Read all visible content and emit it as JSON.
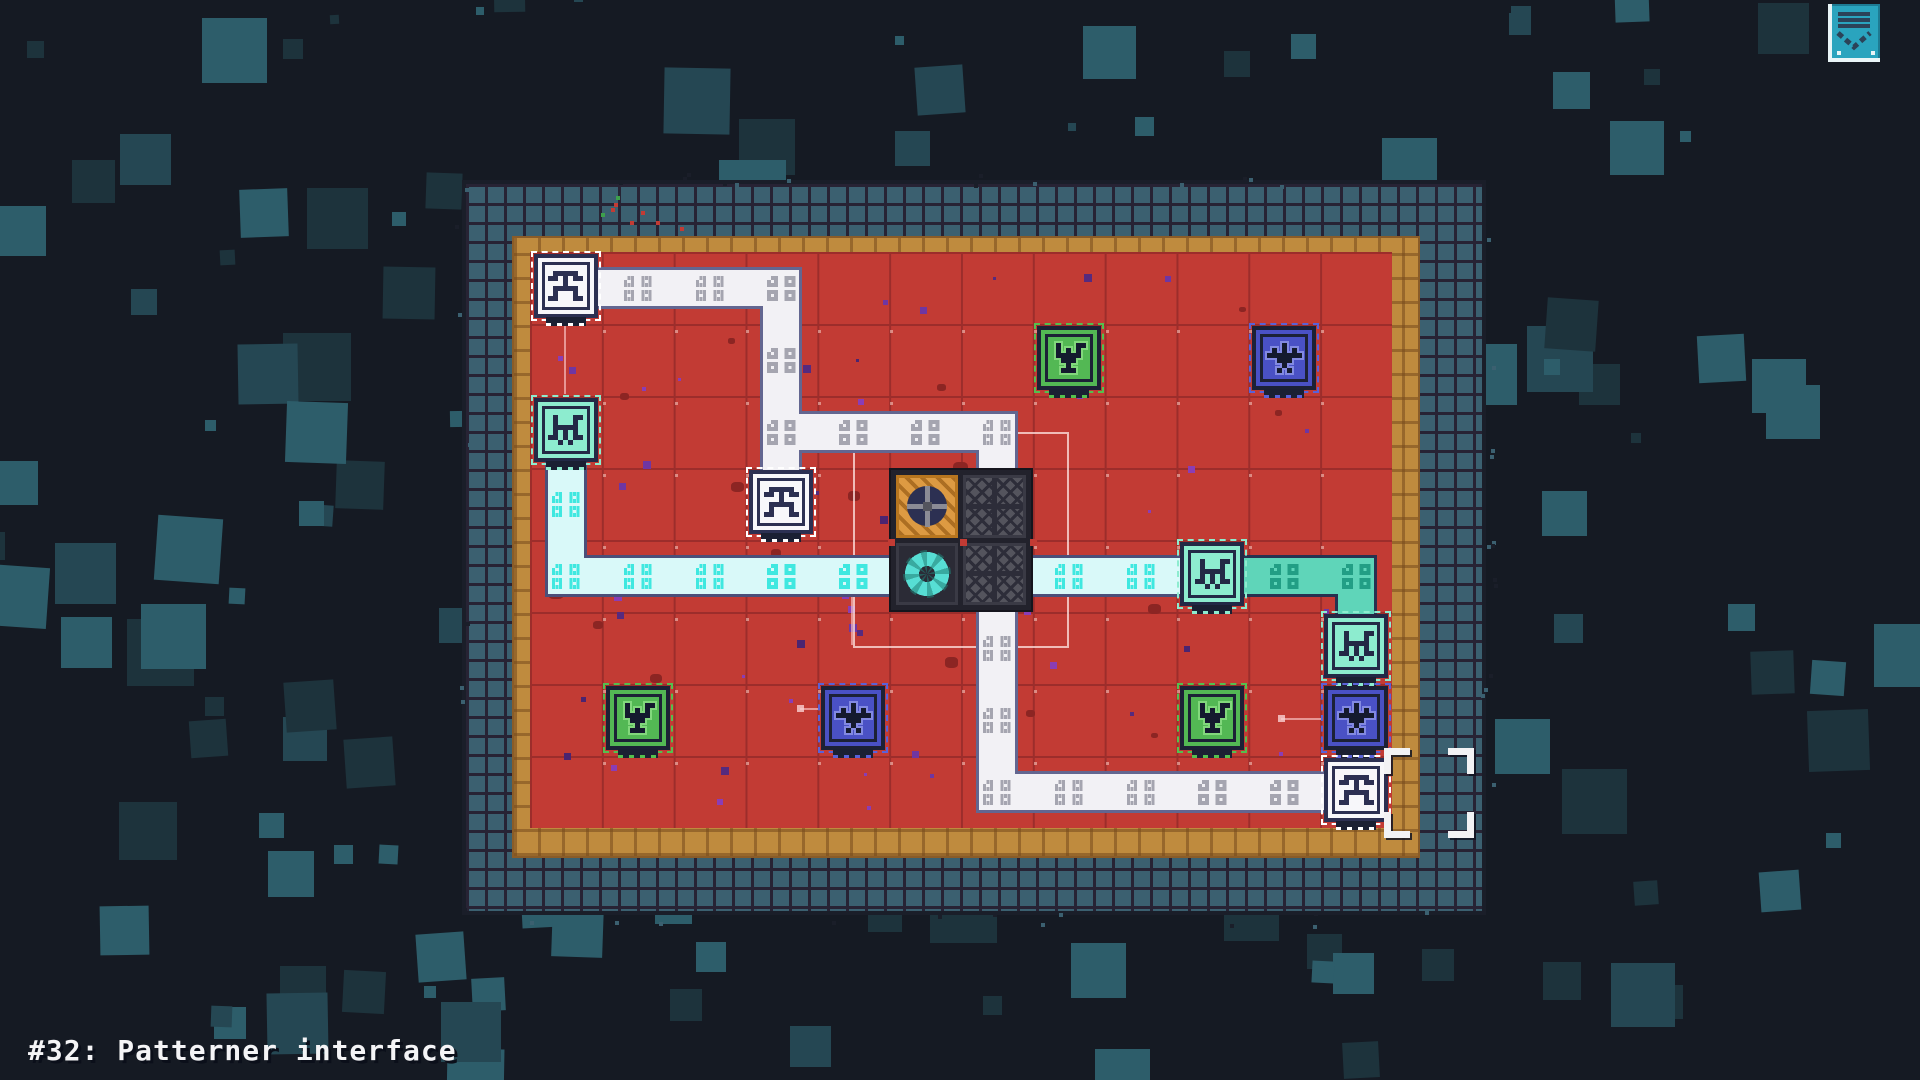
{
  "hud": {
    "level_label": "#32: Patterner interface",
    "menu_button": {
      "icon": "tray-list-icon"
    }
  },
  "palette": {
    "background": "#151a23",
    "background_square_dim": "#1d333c",
    "background_square_mid": "#254753",
    "background_square_bright": "#2d5d6a",
    "frame_fill": "#3b6070",
    "frame_line": "#272334",
    "gold_border": "#bf8b3e",
    "field_red": "#c23b34",
    "field_grid_line": "#9c2d2b",
    "path_white": "#f2f1f5",
    "path_white_ornament": "#a5a5b0",
    "path_cyan": "#d9f9f9",
    "path_cyan_ornament": "#3fe8e0",
    "path_mint": "#5fd5b9",
    "path_mint_ornament": "#229e85",
    "tile_navy": "#2c3052",
    "tile_white_face": "#f7f7fa",
    "tile_mint_face": "#8deccf",
    "tile_green_face": "#53b854",
    "tile_blue_face": "#4a51c5",
    "machine_orange": "#dd9a42",
    "machine_gray": "#54545d",
    "machine_ring_cyan": "#57ded4",
    "selection_white": "#f2f2f4",
    "button_teal": "#2aa4be"
  },
  "board": {
    "cols": 12,
    "rows": 8,
    "geometry": {
      "field_x": 530,
      "field_y": 252,
      "cell_w": 71.833,
      "cell_h": 72,
      "frame": [
        462,
        180,
        1024,
        735
      ],
      "gold": [
        512,
        236,
        908,
        622
      ]
    },
    "tiles": [
      {
        "type": "altar",
        "color": "white",
        "glyph": "altar",
        "col": 0,
        "row": 0
      },
      {
        "type": "emitter",
        "color": "mint",
        "glyph": "emitter",
        "col": 0,
        "row": 2
      },
      {
        "type": "altar",
        "color": "white",
        "glyph": "altar",
        "col": 3,
        "row": 3
      },
      {
        "type": "goblet",
        "color": "green",
        "glyph": "goblet",
        "col": 7,
        "row": 1
      },
      {
        "type": "bird",
        "color": "blue",
        "glyph": "bird",
        "col": 10,
        "row": 1
      },
      {
        "type": "emitter",
        "color": "mint",
        "glyph": "emitter",
        "col": 9,
        "row": 4
      },
      {
        "type": "emitter",
        "color": "mint",
        "glyph": "emitter",
        "col": 11,
        "row": 5
      },
      {
        "type": "bird",
        "color": "blue",
        "glyph": "bird",
        "col": 11,
        "row": 6
      },
      {
        "type": "altar",
        "color": "white",
        "glyph": "altar",
        "col": 11,
        "row": 7
      },
      {
        "type": "goblet",
        "color": "green",
        "glyph": "goblet",
        "col": 1,
        "row": 6
      },
      {
        "type": "bird",
        "color": "blue",
        "glyph": "bird",
        "col": 4,
        "row": 6
      },
      {
        "type": "goblet",
        "color": "green",
        "glyph": "goblet",
        "col": 9,
        "row": 6
      }
    ],
    "machine_block": {
      "col": 5,
      "row": 3,
      "cells": [
        [
          "gear",
          "ornate"
        ],
        [
          "ring",
          "ornate"
        ]
      ]
    },
    "paths": [
      {
        "style": "white",
        "segments": [
          [
            0,
            0,
            3,
            0
          ],
          [
            3,
            0,
            3,
            3
          ],
          [
            3,
            2,
            6,
            2
          ],
          [
            6,
            2,
            6,
            7
          ],
          [
            6,
            7,
            11,
            7
          ]
        ]
      },
      {
        "style": "cyan",
        "segments": [
          [
            0,
            2,
            0,
            4
          ],
          [
            0,
            4,
            9,
            4
          ]
        ]
      },
      {
        "style": "mint",
        "segments": [
          [
            9,
            4,
            11,
            4
          ],
          [
            11,
            4,
            11,
            5
          ]
        ]
      }
    ],
    "selection_outline": {
      "from_cell": [
        4,
        2
      ],
      "to_cell": [
        7,
        5
      ]
    },
    "cursor_cell": [
      11,
      7
    ],
    "link_hints": [
      {
        "x1": 565,
        "y1": 326,
        "x2": 565,
        "y2": 394
      },
      {
        "x1": 852,
        "y1": 596,
        "x2": 852,
        "y2": 645
      },
      {
        "x1": 800,
        "y1": 709,
        "x2": 819,
        "y2": 709,
        "dot": true
      },
      {
        "x1": 1281,
        "y1": 719,
        "x2": 1322,
        "y2": 719,
        "dot": true
      }
    ]
  }
}
